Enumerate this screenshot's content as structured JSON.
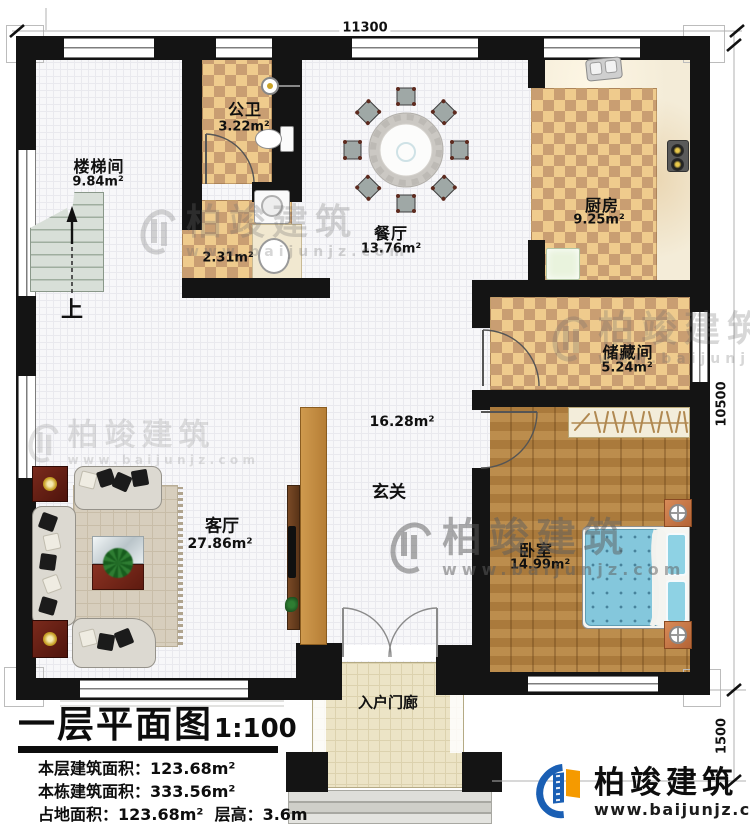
{
  "plan_title": {
    "title": "一层平面图",
    "scale": "1:100"
  },
  "info_lines": [
    "本层建筑面积：123.68m²",
    "本栋建筑面积：333.56m²",
    "占地面积：123.68m²  层高：3.6m"
  ],
  "dimensions": {
    "top": "11300",
    "right_upper": "10500",
    "right_lower": "1500"
  },
  "rooms": {
    "stairwell": {
      "name": "楼梯间",
      "area": "9.84m²"
    },
    "bath": {
      "name": "公卫",
      "area": "3.22m²"
    },
    "utility": {
      "area": "2.31m²"
    },
    "dining": {
      "name": "餐厅",
      "area": "13.76m²"
    },
    "kitchen": {
      "name": "厨房",
      "area": "9.25m²"
    },
    "storage": {
      "name": "储藏间",
      "area": "5.24m²"
    },
    "bedroom": {
      "name": "卧室",
      "area": "14.99m²"
    },
    "living": {
      "name": "客厅",
      "area": "27.86m²"
    },
    "foyer": {
      "name": "玄关",
      "area": "16.28m²"
    },
    "porch": {
      "name": "入户门廊"
    }
  },
  "stair_up_label": "上",
  "watermark": {
    "brand": "柏竣建筑",
    "url": "www.baijunjz.com"
  },
  "logo": {
    "brand": "柏竣建筑",
    "url": "www.baijunjz.com"
  },
  "colors": {
    "wall": "#141414",
    "tile_light": "#efcb8d",
    "tile_dark": "#c99e72",
    "wood_floor": "#b3813f",
    "bed_blue": "#84c7dc",
    "logo_blue": "#1a5fb4",
    "logo_orange": "#f59a00"
  }
}
